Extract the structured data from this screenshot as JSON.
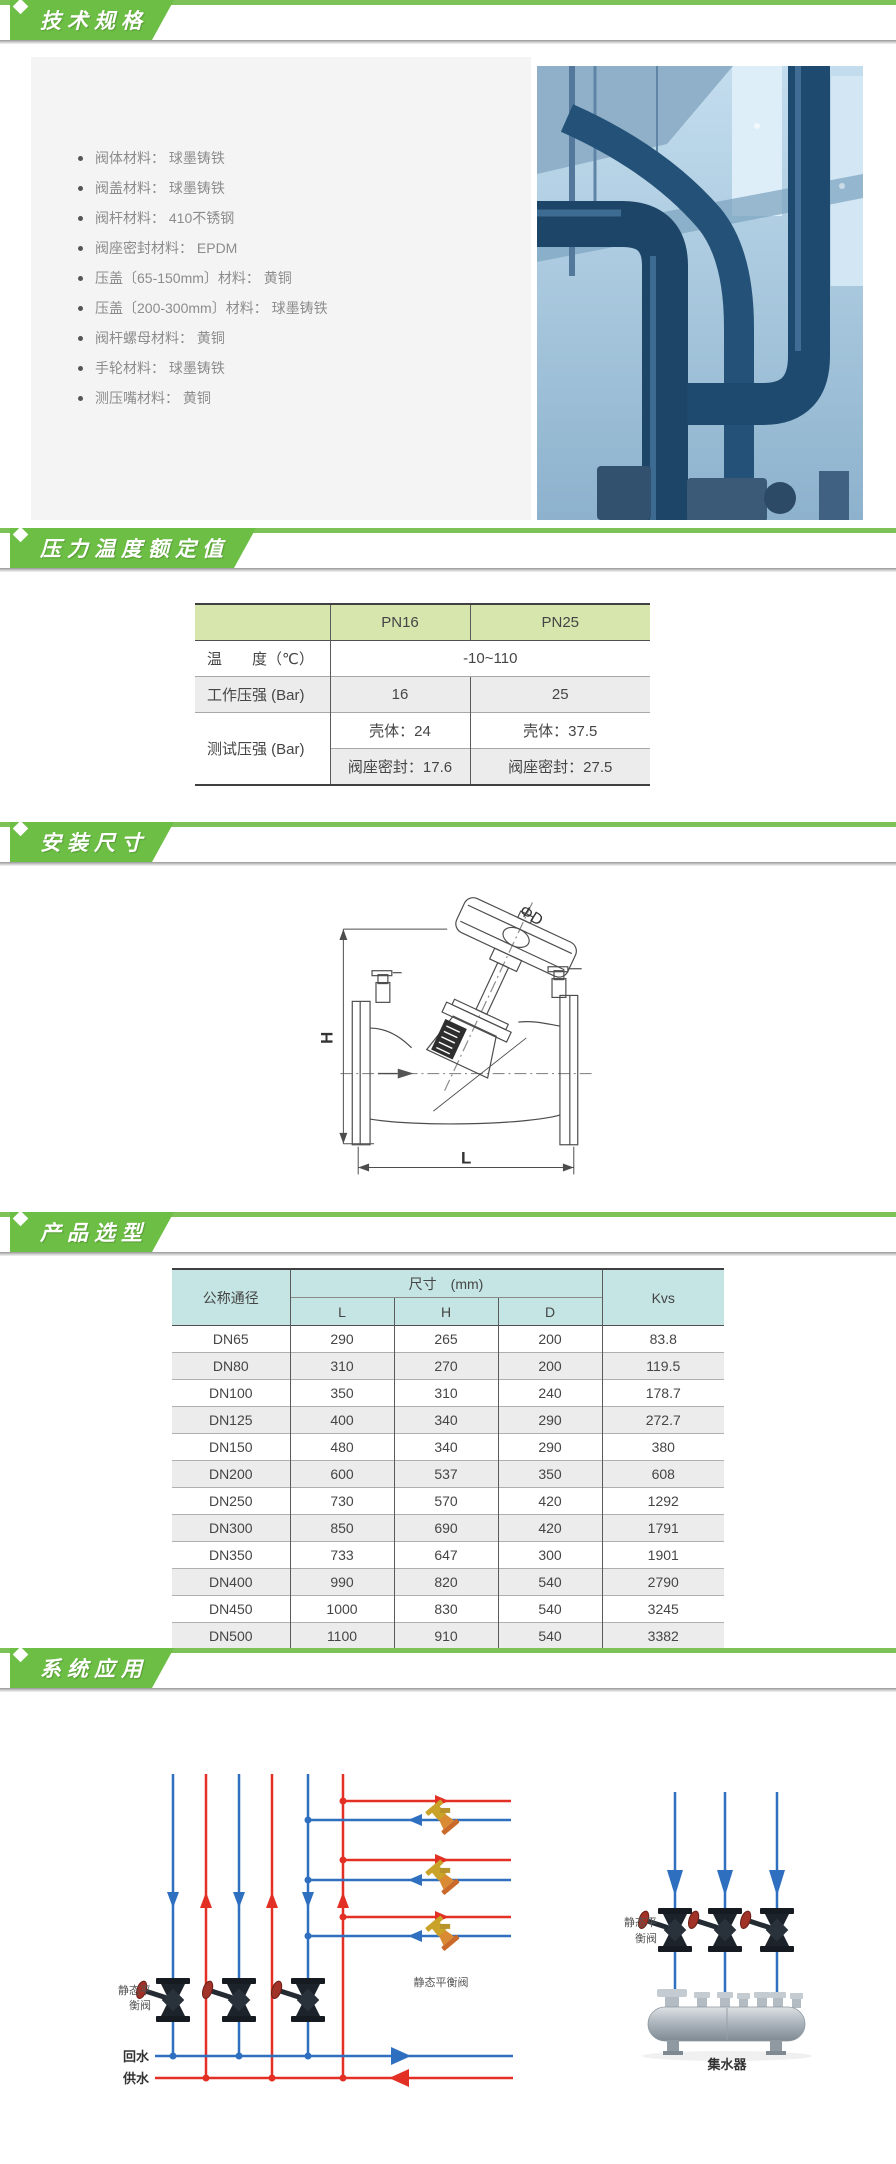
{
  "colors": {
    "brand_green": "#6cbe44",
    "table1_header_bg": "#d6e6ad",
    "table2_header_bg": "#c4e5e3",
    "schematic_blue": "#2f6fc0",
    "schematic_red": "#e33024"
  },
  "specs": {
    "title": "技术规格",
    "bullets": [
      "阀体材料： 球墨铸铁",
      "阀盖材料： 球墨铸铁",
      "阀杆材料： 410不锈钢",
      "阀座密封材料： EPDM",
      "压盖〔65-150mm〕材料： 黄铜",
      "压盖〔200-300mm〕材料： 球墨铸铁",
      "阀杆螺母材料： 黄铜",
      "手轮材料： 球墨铸铁",
      "测压嘴材料： 黄铜"
    ]
  },
  "pressure": {
    "title": "压力温度额定值",
    "table": {
      "col_pn16": "PN16",
      "col_pn25": "PN25",
      "temp_label": "温　　度（℃）",
      "temp_value": "-10~110",
      "work_label": "工作压强 (Bar)",
      "work_pn16": "16",
      "work_pn25": "25",
      "test_label": "测试压强 (Bar)",
      "shell_pn16": "壳体：24",
      "shell_pn25": "壳体：37.5",
      "seat_pn16": "阀座密封：17.6",
      "seat_pn25": "阀座密封：27.5"
    }
  },
  "installation": {
    "title": "安装尺寸",
    "labels": {
      "diameter": "ΦD",
      "height": "H",
      "length": "L"
    }
  },
  "selection": {
    "title": "产品选型",
    "table": {
      "col_dn": "公称通径",
      "dims_header": "尺寸　(mm)",
      "sub_l": "L",
      "sub_h": "H",
      "sub_d": "D",
      "col_kvs": "Kvs",
      "rows": [
        [
          "DN65",
          "290",
          "265",
          "200",
          "83.8"
        ],
        [
          "DN80",
          "310",
          "270",
          "200",
          "119.5"
        ],
        [
          "DN100",
          "350",
          "310",
          "240",
          "178.7"
        ],
        [
          "DN125",
          "400",
          "340",
          "290",
          "272.7"
        ],
        [
          "DN150",
          "480",
          "340",
          "290",
          "380"
        ],
        [
          "DN200",
          "600",
          "537",
          "350",
          "608"
        ],
        [
          "DN250",
          "730",
          "570",
          "420",
          "1292"
        ],
        [
          "DN300",
          "850",
          "690",
          "420",
          "1791"
        ],
        [
          "DN350",
          "733",
          "647",
          "300",
          "1901"
        ],
        [
          "DN400",
          "990",
          "820",
          "540",
          "2790"
        ],
        [
          "DN450",
          "1000",
          "830",
          "540",
          "3245"
        ],
        [
          "DN500",
          "1100",
          "910",
          "540",
          "3382"
        ]
      ]
    }
  },
  "application": {
    "title": "系统应用",
    "left": {
      "valve_label_line1": "静态平",
      "valve_label_line2": "衡阀",
      "yellow_valve_label": "静态平衡阀",
      "return_label": "回水",
      "supply_label": "供水"
    },
    "right": {
      "valve_label_line1": "静态平",
      "valve_label_line2": "衡阀",
      "manifold_label": "集水器"
    }
  }
}
